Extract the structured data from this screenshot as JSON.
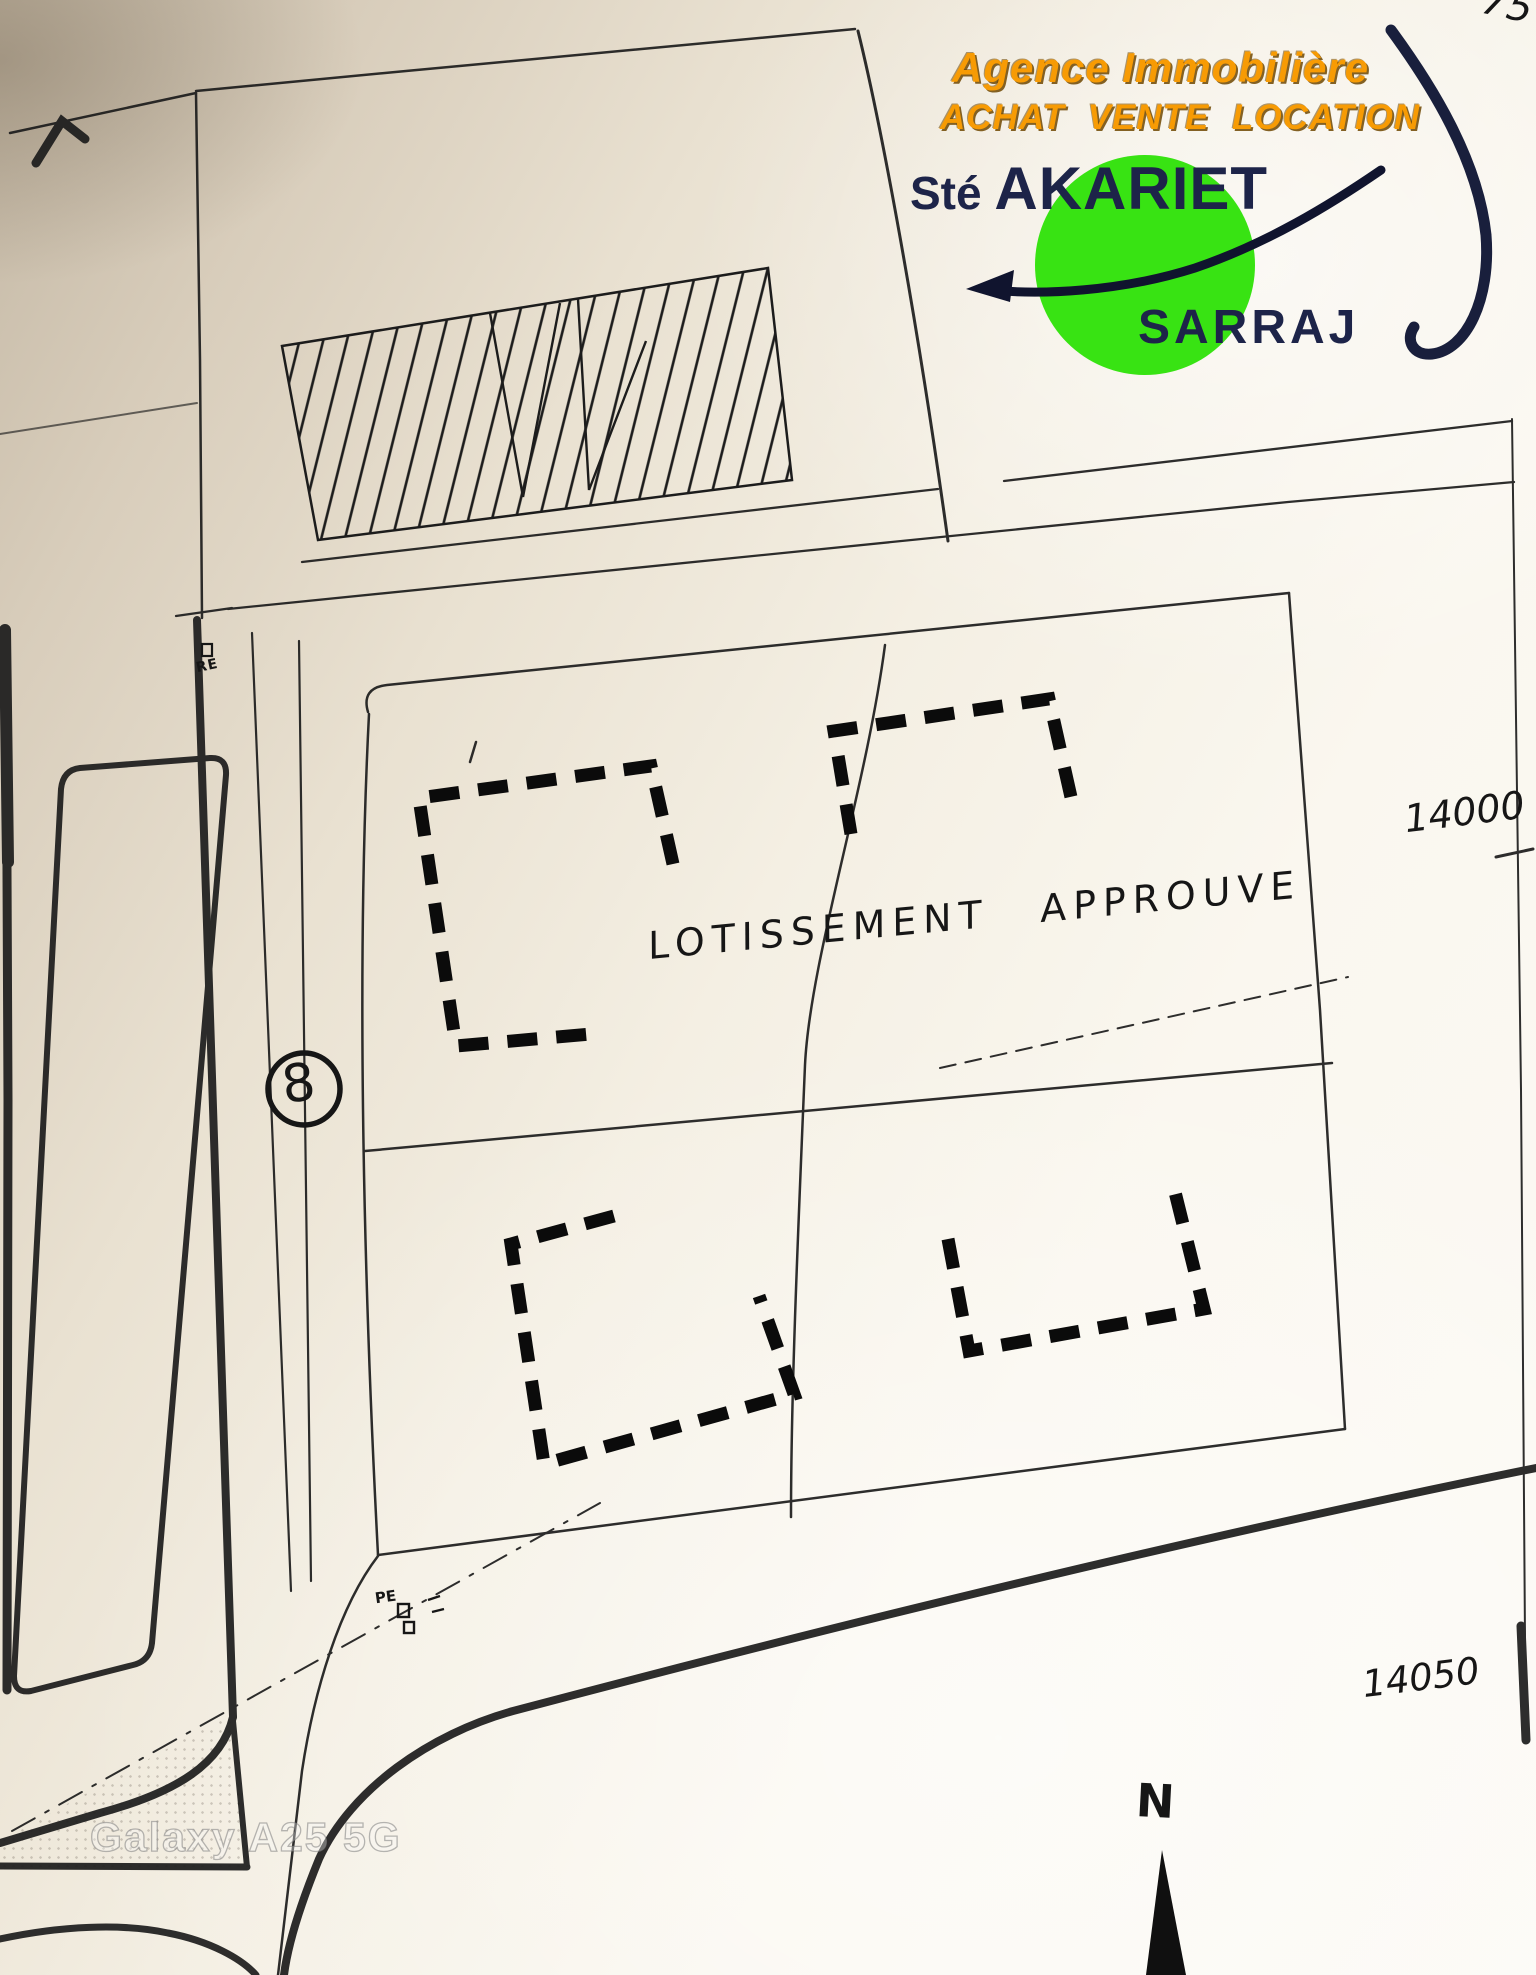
{
  "colors": {
    "accent-orange": "#f79b04",
    "ink-navy": "#1d2449",
    "logo-green": "#38e313",
    "line-ink": "#1c1c1c",
    "paper-dark": "#c3b7a4",
    "paper-light": "#fcfaf5"
  },
  "logo": {
    "tagline_line1": "Agence Immobilière",
    "tagline_line2": "ACHAT VENTE LOCATION",
    "company_prefix": "Sté",
    "company_name": "AKARIET",
    "company_subname": "SARRAJ"
  },
  "plan": {
    "approval_word1": "LOTISSEMENT",
    "approval_word2": "APPROUVE",
    "level_label_top": "14000",
    "level_label_bottom": "14050",
    "road_lot_number": "8",
    "north_label": "N",
    "corner_sheet_note": "75",
    "survey_marker_top": "RE",
    "survey_marker_bottom": "PE"
  },
  "watermark": {
    "text": "Galaxy A25 5G"
  }
}
